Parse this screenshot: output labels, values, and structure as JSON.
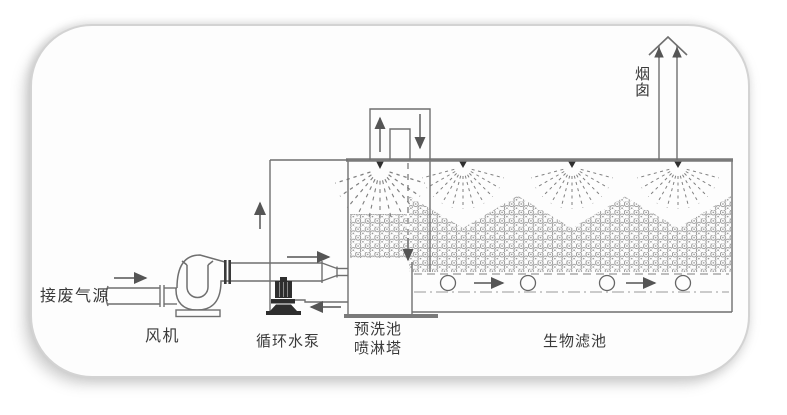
{
  "diagram": {
    "title_implied": "waste-gas biofilter process flow diagram",
    "labels": {
      "inlet": "接废气源",
      "fan": "风机",
      "pump": "循环水泵",
      "prewash_line1": "预洗池",
      "prewash_line2": "喷淋塔",
      "biofilter": "生物滤池",
      "chimney": "烟囱"
    },
    "colors": {
      "background": "#ffffff",
      "card_background": "#fdfdfd",
      "card_border": "#d3d3d3",
      "line": "#6f6f6f",
      "thick_line": "#7a7a7a",
      "media_pattern": "#8f8f8f",
      "dark_fill": "#2e2e2e",
      "text": "#3a3a3a"
    }
  }
}
